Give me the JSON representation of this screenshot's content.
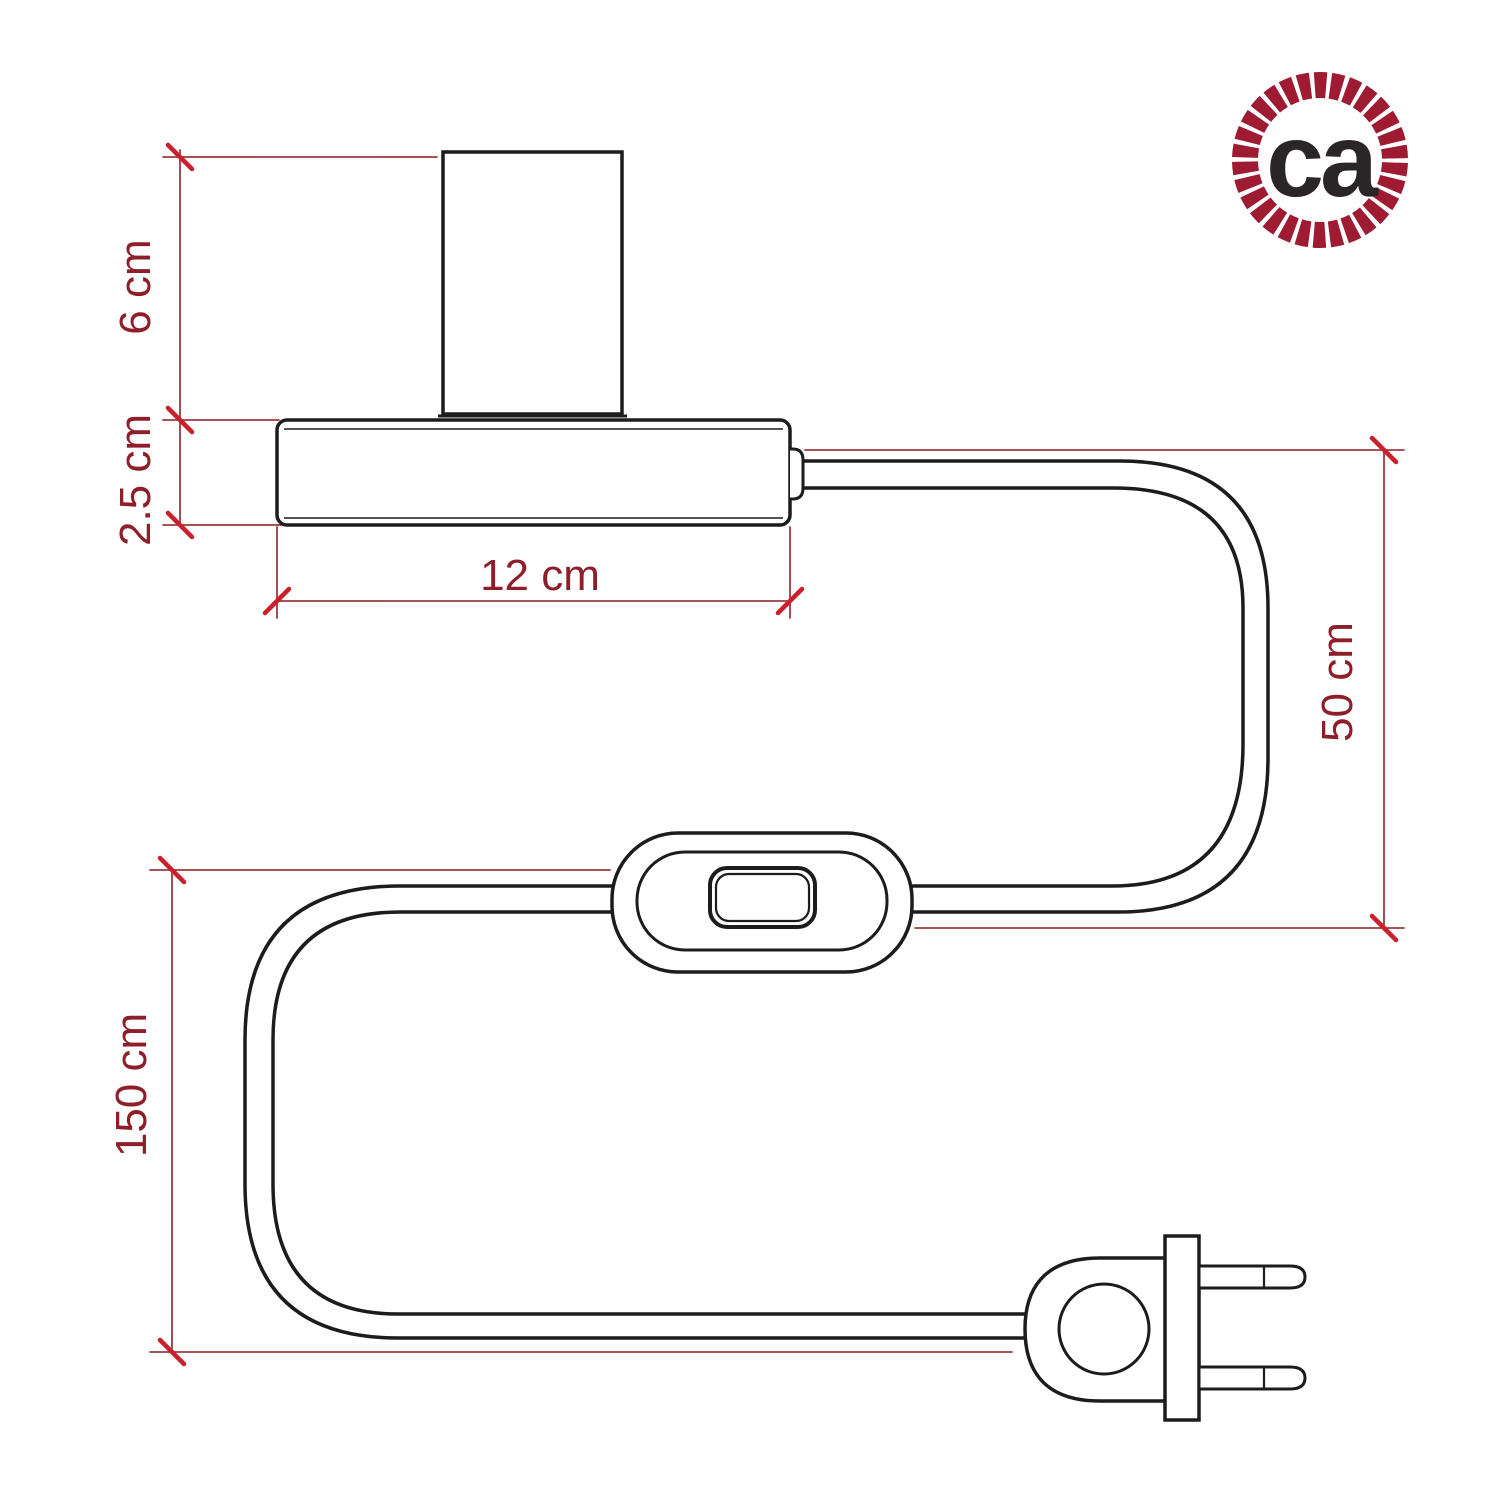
{
  "diagram": {
    "title": "table-lamp-dimension-drawing",
    "labels": {
      "socket_height": "6 cm",
      "base_height": "2.5 cm",
      "base_width": "12 cm",
      "cable_drop": "50 cm",
      "cable_length": "150 cm"
    },
    "logo": {
      "text": "ca"
    },
    "components": {
      "socket": "lamp-socket-cylinder",
      "base": "lamp-base",
      "switch": "inline-rocker-switch",
      "cable": "power-cable",
      "plug": "two-prong-plug"
    },
    "colors": {
      "outline": "#1c1c1c",
      "dimension_text": "#8e1f2a",
      "dimension_line": "#9a3b40",
      "tick": "#c9202b",
      "logo_ring": "#9e1b32",
      "logo_text": "#2a2627",
      "background": "#ffffff"
    }
  }
}
